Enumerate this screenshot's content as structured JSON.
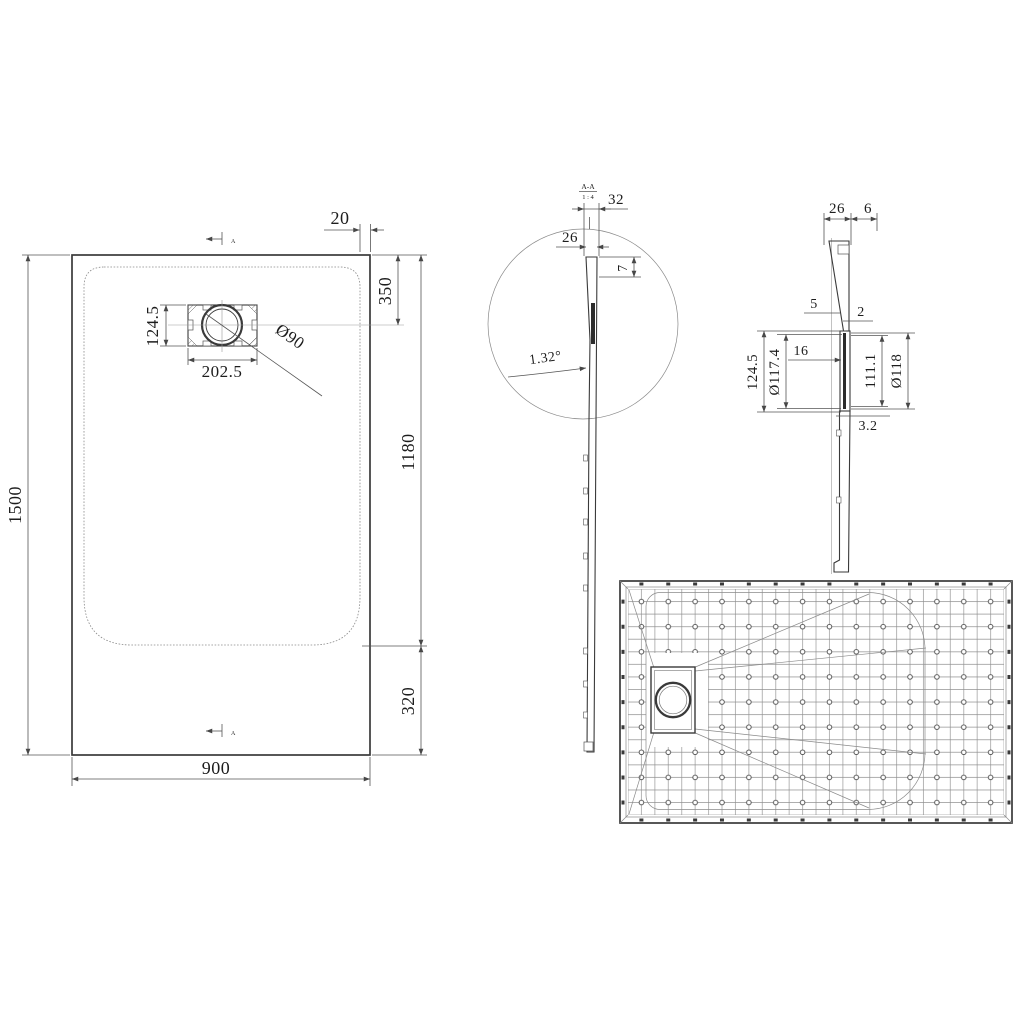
{
  "title": "Shower tray technical drawing",
  "colors": {
    "background": "#ffffff",
    "main_line": "#3a3a3a",
    "thin_line": "#8a8a8a",
    "dimension_line": "#555555",
    "text": "#1d1d1d"
  },
  "plan_view": {
    "section_letter": "A",
    "overall_width": "900",
    "overall_length": "1500",
    "rim_gap": "20",
    "drain_offset_top": "350",
    "floor_length": "1180",
    "bottom_band": "320",
    "drain_box_width": "202.5",
    "drain_box_height": "124.5",
    "drain_hole_dia": "Ø90"
  },
  "section_view": {
    "label": "A-A",
    "scale": "1 : 4",
    "rim_width": "32",
    "lip_width": "26",
    "lip_depth": "7",
    "slope_angle": "1.32°"
  },
  "drain_detail": {
    "flange_width": "26",
    "flange_lip": "6",
    "wall_top": "5",
    "wall_bottom": "2",
    "pocket_height": "124.5",
    "inner_dia": "Ø117.4",
    "recess_depth": "16",
    "recess_height": "111.1",
    "outer_dia": "Ø118",
    "base_wall": "3.2"
  }
}
